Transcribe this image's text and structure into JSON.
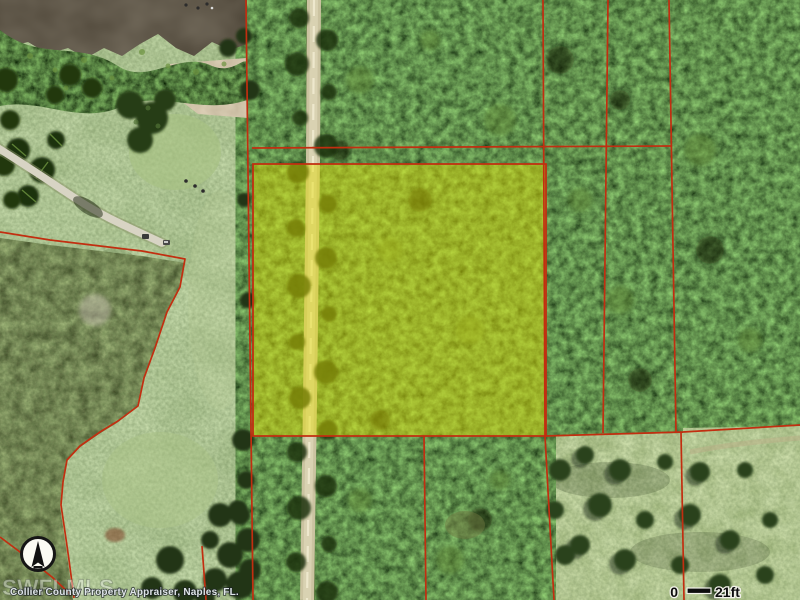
{
  "map": {
    "attribution": "Collier County Property Appraiser, Naples, FL.",
    "watermark": "SWFLMLS",
    "scale_bar": {
      "start_label": "0",
      "end_label": "21ft"
    },
    "colors": {
      "parcel_boundary": "#c22e10",
      "parcel_highlight": "#e4de00"
    }
  }
}
